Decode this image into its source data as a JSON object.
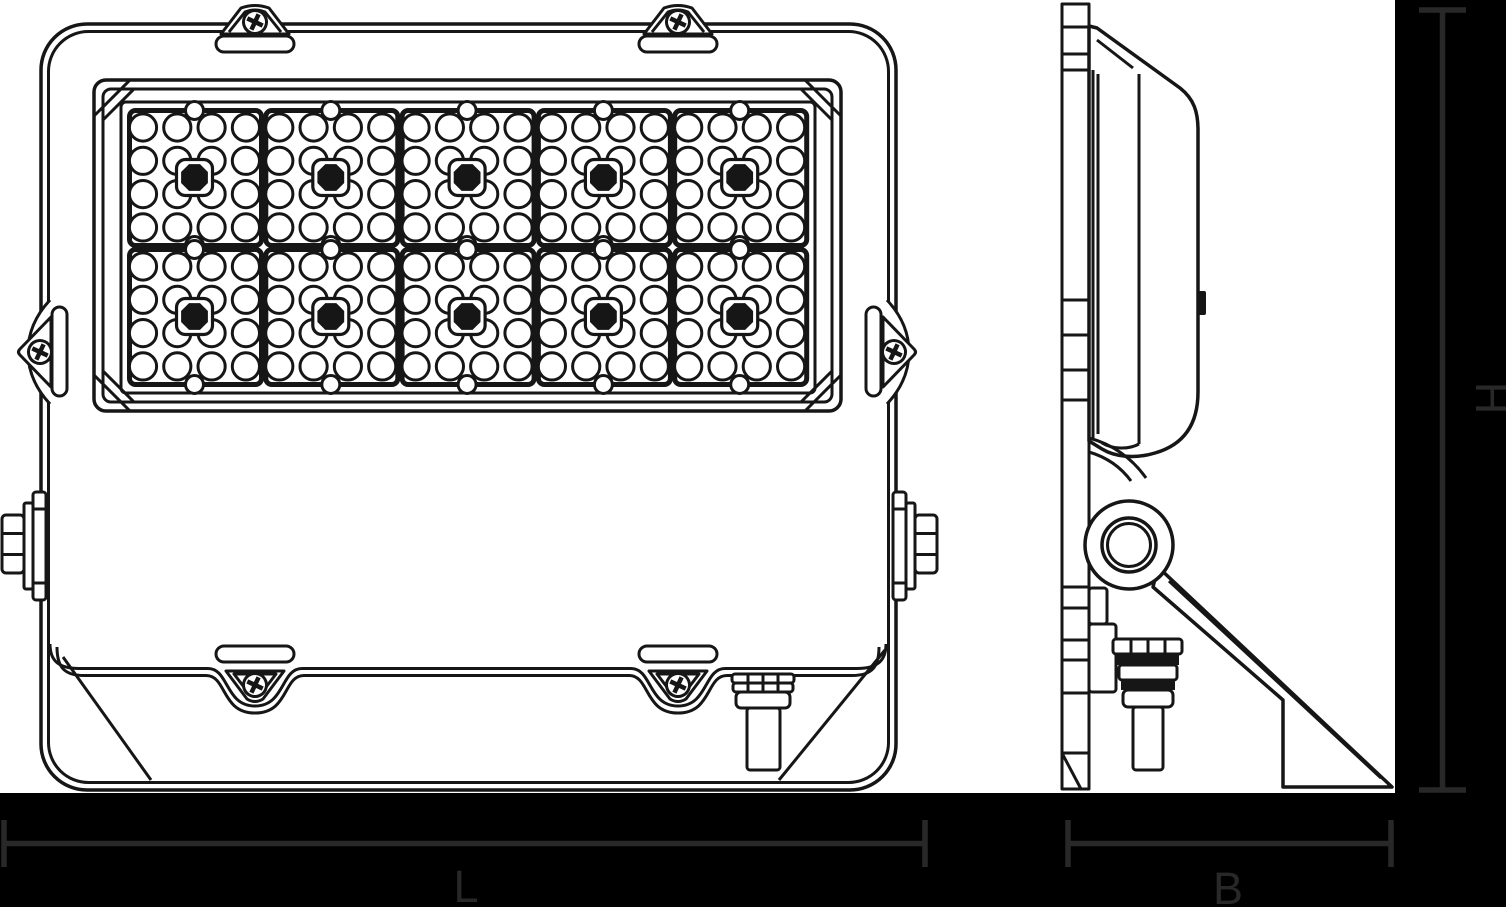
{
  "document": {
    "description": "Technical line drawing of an LED floodlight, front view and side view, with dimension lines",
    "views": [
      "front",
      "side"
    ]
  },
  "dimensions": {
    "length": {
      "label": "L"
    },
    "width": {
      "label": "B"
    },
    "height": {
      "label": "H"
    }
  },
  "led_panel": {
    "module_columns": 5,
    "module_rows": 2,
    "lens_columns": 4,
    "lens_rows": 4,
    "led_count": 10
  },
  "colors": {
    "background": "#000000",
    "paper": "#ffffff",
    "ink": "#161616",
    "dimension": "#282828"
  }
}
